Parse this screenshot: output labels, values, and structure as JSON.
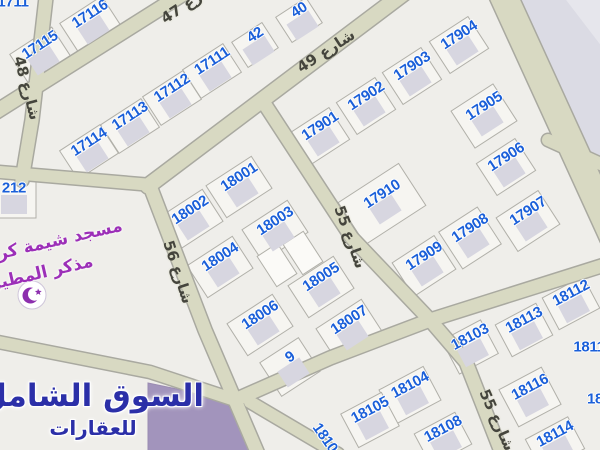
{
  "map": {
    "colors": {
      "background": "#efeeea",
      "road_fill": "#d8d9c2",
      "road_edge": "#a9a9a0",
      "parcel_fill": "#f6f5f1",
      "parcel_stroke": "#b1b0a9",
      "building": "#d7d6e0",
      "plot_number": "#1a5fd9",
      "street_text": "#45453d",
      "mosque_text": "#9c2fb8",
      "watermark_text": "#2b2fa8",
      "special_parcel": "#a294bc",
      "ne_block": "#dbdbe4"
    },
    "plots": [
      {
        "n": "17116",
        "x": 90,
        "y": 14,
        "r": -33,
        "w": 50,
        "h": 34
      },
      {
        "n": "17115",
        "x": 40,
        "y": 45,
        "r": -33,
        "w": 50,
        "h": 34
      },
      {
        "n": "40",
        "x": 299,
        "y": 10,
        "r": -33,
        "w": 36,
        "h": 30
      },
      {
        "n": "42",
        "x": 255,
        "y": 35,
        "r": -33,
        "w": 36,
        "h": 30
      },
      {
        "n": "17111",
        "x": 212,
        "y": 61,
        "r": -33,
        "w": 48,
        "h": 34
      },
      {
        "n": "17112",
        "x": 172,
        "y": 88,
        "r": -33,
        "w": 48,
        "h": 34
      },
      {
        "n": "17113",
        "x": 130,
        "y": 116,
        "r": -33,
        "w": 48,
        "h": 34
      },
      {
        "n": "17114",
        "x": 89,
        "y": 142,
        "r": -33,
        "w": 48,
        "h": 34
      },
      {
        "n": "17904",
        "x": 459,
        "y": 35,
        "r": -33,
        "w": 46,
        "h": 38
      },
      {
        "n": "17903",
        "x": 412,
        "y": 66,
        "r": -33,
        "w": 46,
        "h": 38
      },
      {
        "n": "17902",
        "x": 366,
        "y": 96,
        "r": -33,
        "w": 46,
        "h": 38
      },
      {
        "n": "17901",
        "x": 320,
        "y": 126,
        "r": -33,
        "w": 46,
        "h": 38
      },
      {
        "n": "17905",
        "x": 484,
        "y": 106,
        "r": -33,
        "w": 50,
        "h": 44
      },
      {
        "n": "17906",
        "x": 506,
        "y": 157,
        "r": -33,
        "w": 46,
        "h": 38
      },
      {
        "n": "17910",
        "x": 382,
        "y": 194,
        "r": -33,
        "w": 72,
        "h": 50
      },
      {
        "n": "17907",
        "x": 528,
        "y": 211,
        "r": -33,
        "w": 50,
        "h": 40
      },
      {
        "n": "17908",
        "x": 470,
        "y": 228,
        "r": -33,
        "w": 46,
        "h": 44
      },
      {
        "n": "17909",
        "x": 424,
        "y": 256,
        "r": -33,
        "w": 50,
        "h": 40
      },
      {
        "n": "18001",
        "x": 239,
        "y": 177,
        "r": -33,
        "w": 54,
        "h": 38
      },
      {
        "n": "18002",
        "x": 190,
        "y": 210,
        "r": -33,
        "w": 54,
        "h": 38
      },
      {
        "n": "18003",
        "x": 275,
        "y": 221,
        "r": -33,
        "w": 54,
        "h": 38
      },
      {
        "n": "18004",
        "x": 220,
        "y": 257,
        "r": -33,
        "w": 54,
        "h": 38
      },
      {
        "n": "18005",
        "x": 321,
        "y": 277,
        "r": -33,
        "w": 54,
        "h": 38
      },
      {
        "n": "18006",
        "x": 260,
        "y": 315,
        "r": -33,
        "w": 54,
        "h": 38
      },
      {
        "n": "18007",
        "x": 349,
        "y": 320,
        "r": -33,
        "w": 54,
        "h": 38
      },
      {
        "n": "9",
        "x": 290,
        "y": 357,
        "r": -33,
        "w": 46,
        "h": 40
      },
      {
        "n": "18103",
        "x": 470,
        "y": 337,
        "r": -28,
        "w": 44,
        "h": 38
      },
      {
        "n": "18113",
        "x": 524,
        "y": 320,
        "r": -28,
        "w": 46,
        "h": 36
      },
      {
        "n": "18112",
        "x": 571,
        "y": 293,
        "r": -28,
        "w": 46,
        "h": 36
      },
      {
        "n": "18116",
        "x": 530,
        "y": 387,
        "r": -28,
        "w": 48,
        "h": 42
      },
      {
        "n": "18114",
        "x": 555,
        "y": 434,
        "r": -28,
        "w": 48,
        "h": 36
      },
      {
        "n": "18104",
        "x": 410,
        "y": 385,
        "r": -28,
        "w": 50,
        "h": 38
      },
      {
        "n": "18105",
        "x": 370,
        "y": 410,
        "r": -28,
        "w": 46,
        "h": 38
      },
      {
        "n": "18108",
        "x": 443,
        "y": 429,
        "r": -28,
        "w": 46,
        "h": 36
      },
      {
        "n": "212",
        "x": 14,
        "y": 188,
        "r": 0,
        "w": 44,
        "h": 40
      }
    ],
    "partial_plot_numbers": [
      {
        "n": "1711",
        "x": 13,
        "y": 2
      },
      {
        "n": "1811",
        "x": 589,
        "y": 347
      },
      {
        "n": "18",
        "x": 595,
        "y": 399
      },
      {
        "n": "1810",
        "x": 325,
        "y": 438,
        "r": 55
      }
    ],
    "streets": [
      {
        "name": "شارع 47",
        "x": 190,
        "y": 2,
        "r": -33
      },
      {
        "name": "شارع 49",
        "x": 326,
        "y": 51,
        "r": -33
      },
      {
        "name": "شارع 55",
        "x": 350,
        "y": 237,
        "r": 70
      },
      {
        "name": "شارع 55",
        "x": 497,
        "y": 420,
        "r": 66
      },
      {
        "name": "شارع 56",
        "x": 178,
        "y": 272,
        "r": 72
      },
      {
        "name": "شارع 48",
        "x": 27,
        "y": 88,
        "r": 75
      }
    ],
    "mosque": {
      "line1": "مسجد شيمة كر",
      "line2": "مذكر المطير"
    }
  },
  "watermark": {
    "line1": "السوق الشامل",
    "line2": "للعقارات"
  }
}
